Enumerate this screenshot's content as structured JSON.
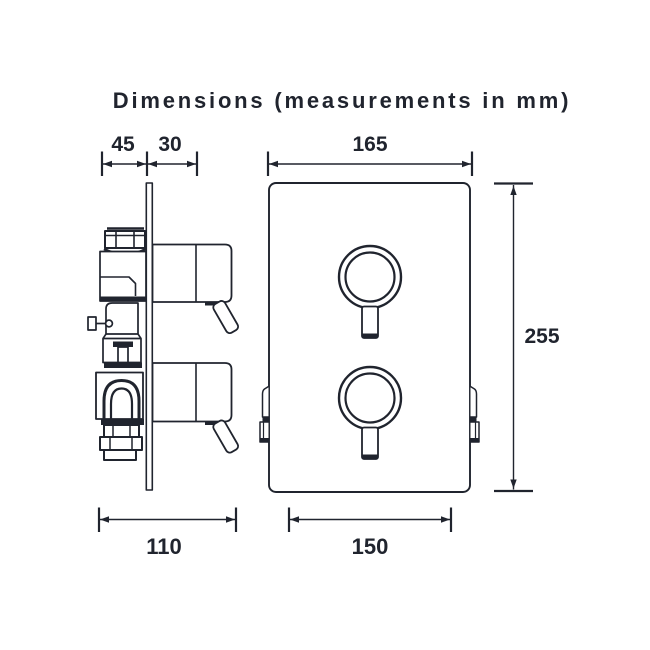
{
  "title": "Dimensions (measurements in mm)",
  "colors": {
    "ink": "#20242e",
    "background": "#ffffff"
  },
  "side_view": {
    "dims": {
      "behind_plate_depth": "45",
      "front_projection": "30",
      "overall_depth": "110"
    }
  },
  "front_view": {
    "dims": {
      "plate_width": "165",
      "plate_height": "255",
      "bottom_width": "150"
    }
  }
}
